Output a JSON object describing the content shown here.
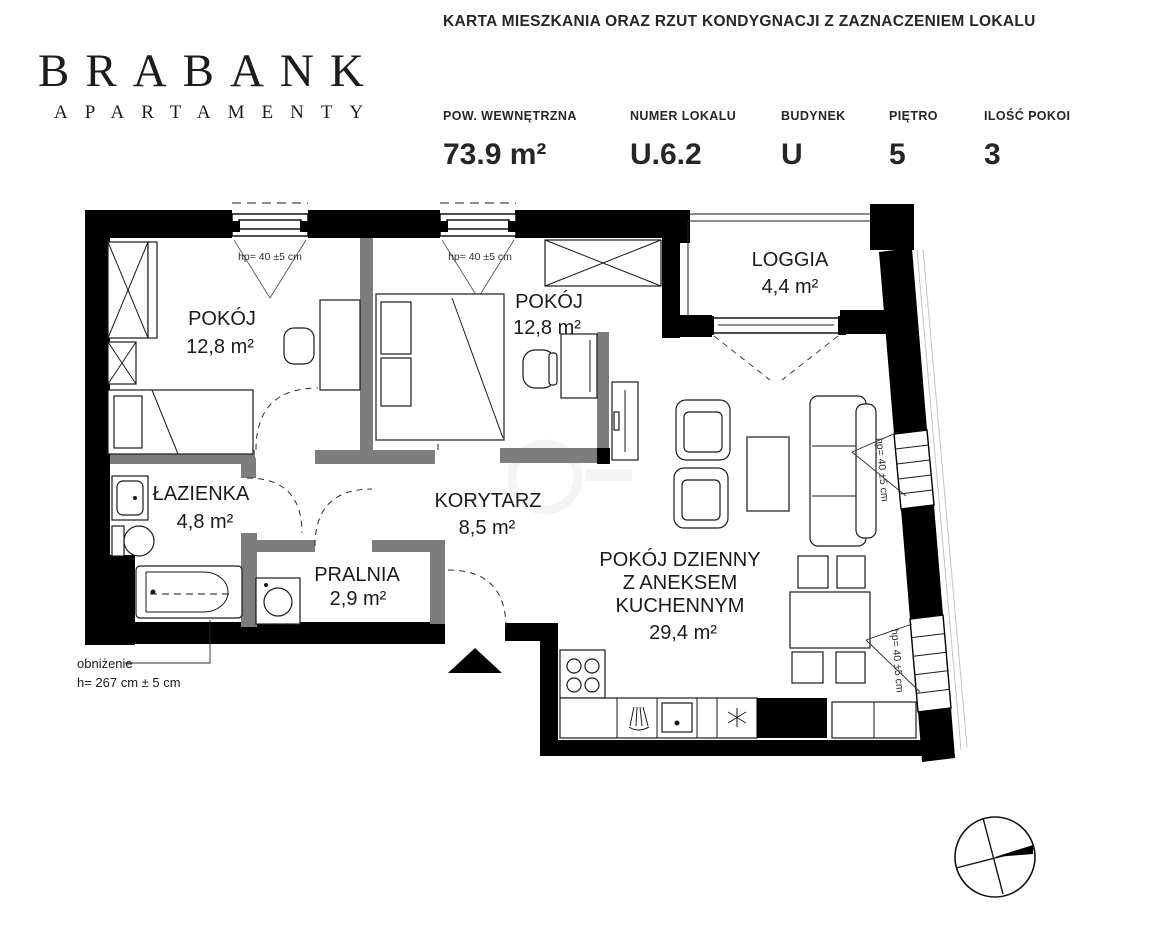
{
  "header": {
    "logo": {
      "name": "BRABANK",
      "subtitle": "APARTAMENTY"
    },
    "title": "KARTA MIESZKANIA ORAZ RZUT KONDYGNACJI Z ZAZNACZENIEM LOKALU",
    "specs": {
      "area": {
        "label": "POW. WEWNĘTRZNA",
        "value": "73.9 m²"
      },
      "unit": {
        "label": "NUMER LOKALU",
        "value": "U.6.2"
      },
      "building": {
        "label": "BUDYNEK",
        "value": "U"
      },
      "floor": {
        "label": "PIĘTRO",
        "value": "5"
      },
      "room_count": {
        "label": "ILOŚĆ POKOI",
        "value": "3"
      }
    }
  },
  "plan": {
    "rooms": {
      "room1": {
        "name": "POKÓJ",
        "area": "12,8 m²"
      },
      "room2": {
        "name": "POKÓJ",
        "area": "12,8 m²"
      },
      "loggia": {
        "name": "LOGGIA",
        "area": "4,4 m²"
      },
      "bathroom": {
        "name": "ŁAZIENKA",
        "area": "4,8 m²"
      },
      "hallway": {
        "name": "KORYTARZ",
        "area": "8,5 m²"
      },
      "laundry": {
        "name": "PRALNIA",
        "area": "2,9 m²"
      },
      "living": {
        "name_line1": "POKÓJ DZIENNY",
        "name_line2": "Z ANEKSEM",
        "name_line3": "KUCHENNYM",
        "area": "29,4 m²"
      }
    },
    "annotations": {
      "window_height": "hp= 40 ±5 cm",
      "lowering_label": "obniżenie",
      "lowering_value": "h= 267 cm ± 5 cm"
    }
  }
}
